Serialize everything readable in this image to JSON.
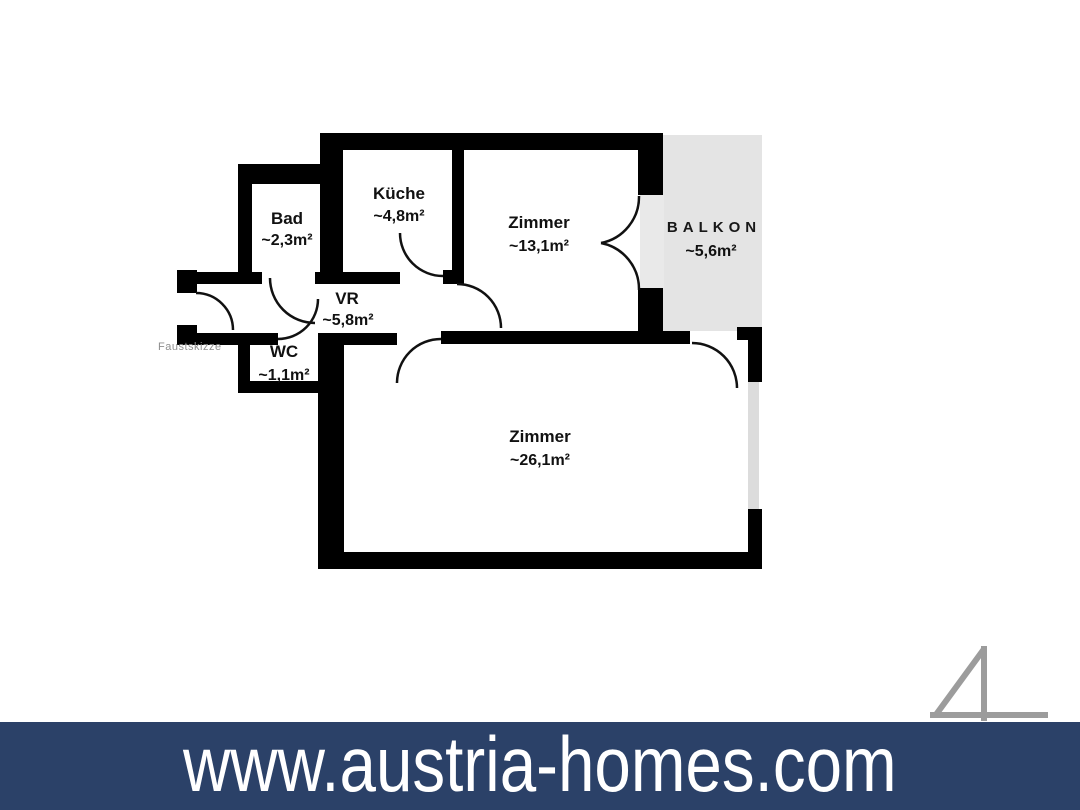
{
  "floorplan": {
    "sketch_type_label": "Faustskizze",
    "rooms": {
      "bad": {
        "name": "Bad",
        "area": "~2,3m²"
      },
      "kueche": {
        "name": "Küche",
        "area": "~4,8m²"
      },
      "zimmer_klein": {
        "name": "Zimmer",
        "area": "~13,1m²"
      },
      "balkon": {
        "name": "BALKON",
        "area": "~5,6m²"
      },
      "vr": {
        "name": "VR",
        "area": "~5,8m²"
      },
      "wc": {
        "name": "WC",
        "area": "~1,1m²"
      },
      "zimmer_gross": {
        "name": "Zimmer",
        "area": "~26,1m²"
      }
    },
    "colors": {
      "wall": "#000000",
      "balcony_fill": "#e4e4e4",
      "threshold_fill": "#e9e9e9",
      "window_fill": "#dcdcdc",
      "label_text": "#111111",
      "sketch_label_text": "#8e8e8e"
    }
  },
  "logo": {
    "shape": "4",
    "color": "#9c9c9c"
  },
  "footer": {
    "website_url_text": "www.austria-homes.com",
    "background": "#2b4168",
    "text_color": "#ffffff"
  }
}
